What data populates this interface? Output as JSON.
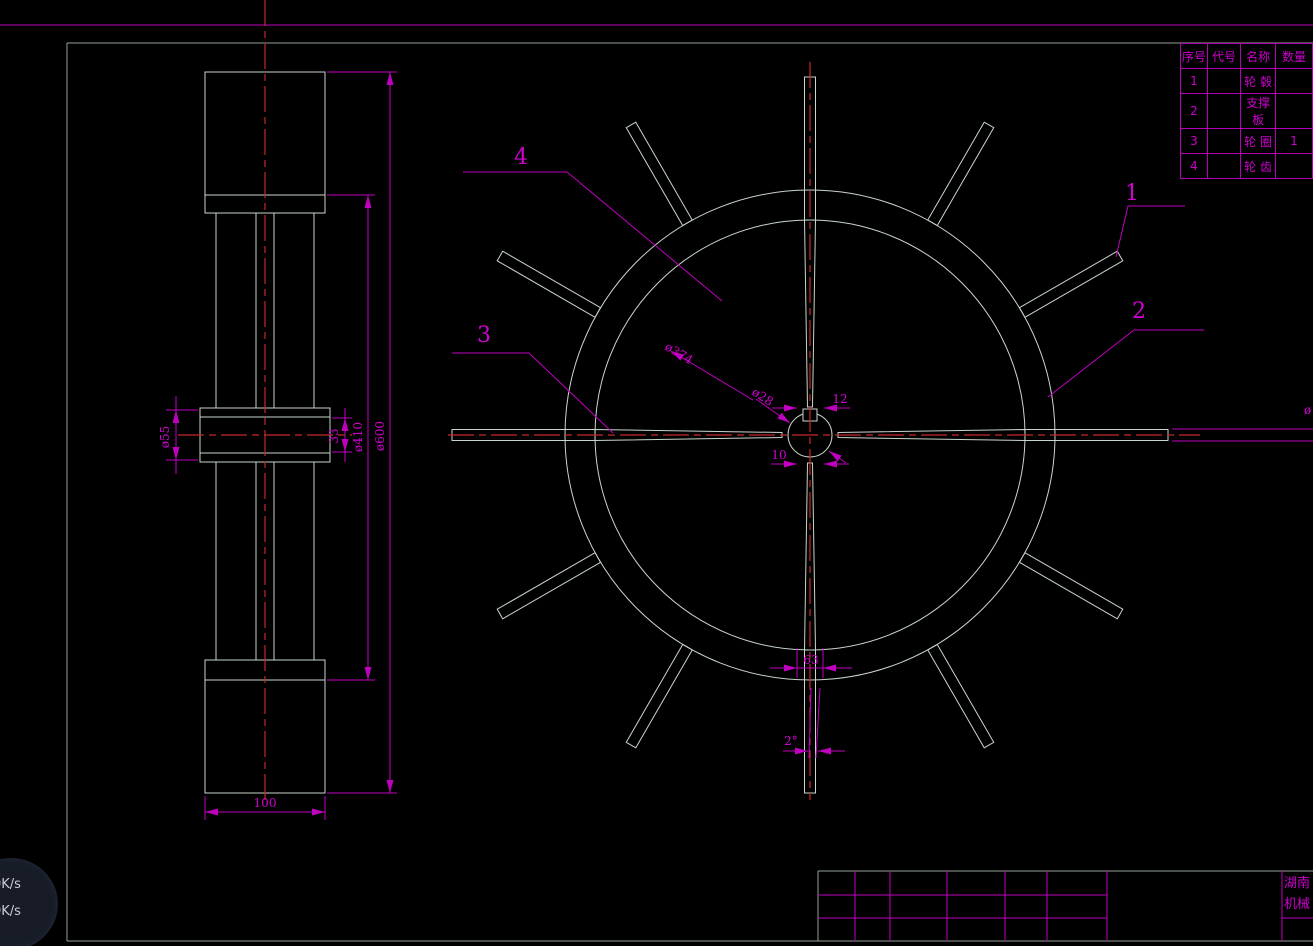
{
  "colors": {
    "background": "#000000",
    "geometry": "#c9d6cb",
    "frame": "#93a296",
    "dimension_magenta": "#bf00bf",
    "text_magenta": "#d400d4",
    "centerline_red": "#c62828",
    "widget_bg": "#171c27",
    "widget_text": "#c9ced8"
  },
  "drawing": {
    "dims": {
      "dia55": "ø55",
      "dim33": "33",
      "dia410": "ø410",
      "dia600": "ø600",
      "dim100": "100",
      "dia374": "ø374",
      "dia28": "ø28",
      "dim12": "12",
      "dim10": "10",
      "dim63": "63",
      "angle2": "2°",
      "dia_cutoff": "ø"
    },
    "balloons": {
      "b1": "1",
      "b2": "2",
      "b3": "3",
      "b4": "4"
    }
  },
  "wheel": {
    "cx": 810,
    "cy": 435,
    "rim_outer_r": 245,
    "rim_inner_r": 215,
    "hub_r": 22,
    "blade_w": 11,
    "blade_tip_r": 358,
    "spokes": [
      {
        "angle": 0,
        "reach_hub": true
      },
      {
        "angle": 30,
        "reach_hub": false
      },
      {
        "angle": 60,
        "reach_hub": false
      },
      {
        "angle": 90,
        "reach_hub": true
      },
      {
        "angle": 120,
        "reach_hub": false
      },
      {
        "angle": 150,
        "reach_hub": false
      },
      {
        "angle": 180,
        "reach_hub": true
      },
      {
        "angle": 210,
        "reach_hub": false
      },
      {
        "angle": 240,
        "reach_hub": false
      },
      {
        "angle": 270,
        "reach_hub": true
      },
      {
        "angle": 300,
        "reach_hub": false
      },
      {
        "angle": 330,
        "reach_hub": false
      }
    ]
  },
  "parts_table": {
    "headers": [
      "序号",
      "代号",
      "名称",
      "数量"
    ],
    "rows": [
      {
        "no": "1",
        "code": "",
        "name": "轮 毂",
        "qty": ""
      },
      {
        "no": "2",
        "code": "",
        "name": "支撑板",
        "qty": ""
      },
      {
        "no": "3",
        "code": "",
        "name": "轮 圈",
        "qty": "1"
      },
      {
        "no": "4",
        "code": "",
        "name": "轮 齿",
        "qty": ""
      }
    ]
  },
  "title_block": {
    "company_line1": "湖南",
    "company_line2": "机械"
  },
  "speed_widget": {
    "up": "0K/s",
    "down": "0K/s"
  }
}
